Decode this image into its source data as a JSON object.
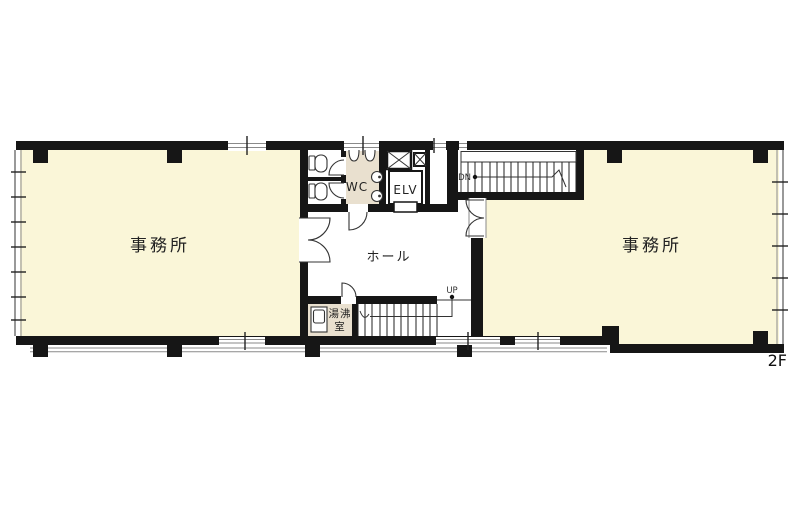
{
  "floor": {
    "label": "2F"
  },
  "rooms": {
    "office_left": {
      "label": "事務所"
    },
    "office_right": {
      "label": "事務所"
    },
    "hall": {
      "label": "ホール"
    },
    "wc": {
      "label": "WC"
    },
    "elevator": {
      "label": "ELV"
    },
    "kitchenette": {
      "label": "湯沸室",
      "line1": "湯沸",
      "line2": "室"
    }
  },
  "stairs": {
    "down": {
      "label": "DN"
    },
    "up": {
      "label": "UP"
    }
  },
  "colors": {
    "wall": "#161616",
    "office_fill": "#faf6d8",
    "service_fill": "#e9e0cf",
    "background": "#ffffff",
    "line": "#333333"
  }
}
